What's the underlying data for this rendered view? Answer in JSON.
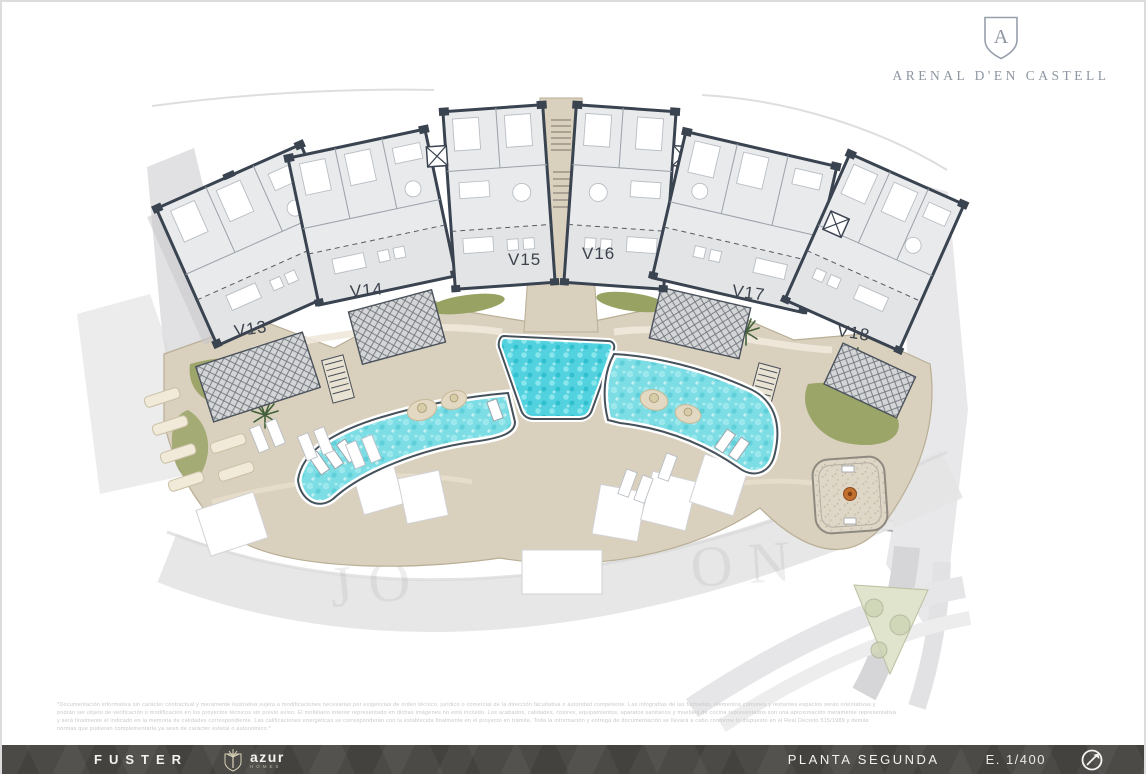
{
  "brand": {
    "name": "ARENAL D'EN CASTELL",
    "monogram": "A"
  },
  "units": [
    {
      "label": "V13"
    },
    {
      "label": "V14"
    },
    {
      "label": "V15"
    },
    {
      "label": "V16"
    },
    {
      "label": "V17"
    },
    {
      "label": "V18"
    }
  ],
  "watermark": {
    "left": "JO",
    "right": "ON"
  },
  "footer": {
    "developer": "FUSTER",
    "builder": "azur",
    "builder_sub": "HOMES",
    "plan_title": "PLANTA SEGUNDA",
    "scale": "E. 1/400"
  },
  "disclaimer": {
    "lines": [
      "*Documentación informativa sin carácter contractual y meramente ilustrativa sujeta a modificaciones necesarias por exigencias de orden técnico, jurídico o comercial de la dirección facultativa o autoridad competente. Las infografías de las fachadas, elementos comunes y restantes espacios serán orientativas y",
      "podrán ser objeto de verificación o modificación en los proyectos técnicos sin previo aviso. El mobiliario interior representado en dichas imágenes no está incluido. Los acabados, calidades, colores, equipamientos, aparatos sanitarios y muebles de cocina representados son una aproximación meramente representativa",
      "y será finalmente el indicado en la memoria de calidades correspondiente. Las calificaciones energéticas se corresponderán con la establecida finalmente en el proyecto en trámite. Toda la información y entrega de documentación se llevará a cabo conforme lo dispuesto en el Real Decreto 515/1989 y demás",
      "normas que pudieran complementarla ya sean de carácter estatal o autonómico.*"
    ]
  },
  "colors": {
    "deck": "#d9d0bd",
    "building_wall": "#3a4350",
    "building_fill": "#e9eaec",
    "water": "#7ddde4",
    "water_bright": "#52d2de",
    "green": "#93a05e",
    "road": "#dcdcde",
    "lawn": "#e1e4cd",
    "accent": "#c2702f",
    "bar": "#4b4a46"
  }
}
